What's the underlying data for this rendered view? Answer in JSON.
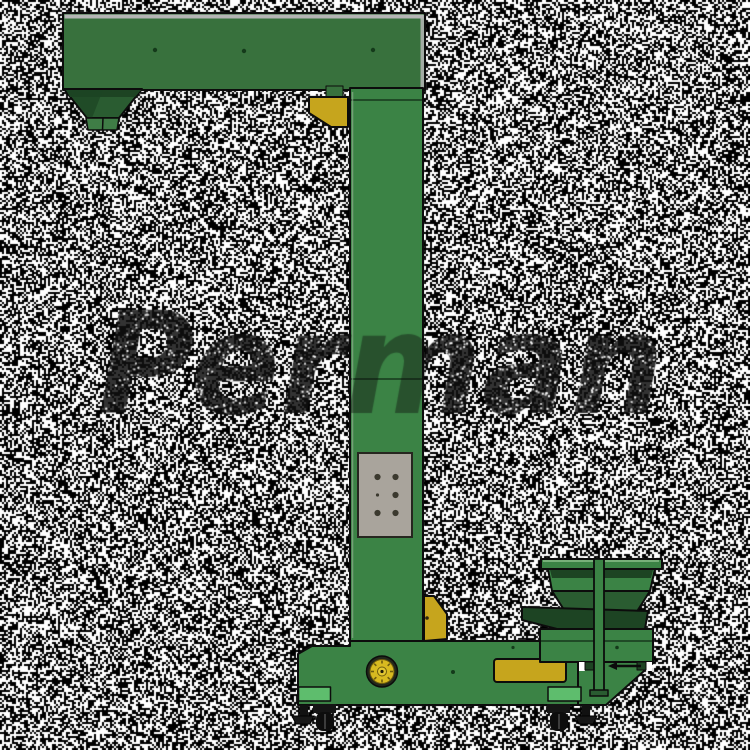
{
  "scene": {
    "background_color": "#ffffff",
    "width": 750,
    "height": 750
  },
  "watermark": {
    "text": "Perman",
    "color": "#0f0f0f",
    "opacity": 0.85,
    "font_px": 140,
    "x": 98,
    "baseline_y": 413,
    "target_width": 566,
    "speck_color": "#ffffff",
    "speck_density": 0.085,
    "speck_size": 2,
    "machine_strip_x0": 349,
    "machine_strip_x1": 426,
    "machine_fade": 0.5,
    "seed": 424242
  },
  "noise": {
    "color": "#000000",
    "density": 0.52,
    "dot_size": 2,
    "seed": 1234567
  },
  "palette": {
    "outline": "#0c0c0c",
    "green_main": "#3b8345",
    "green_arm": "#38713d",
    "green_dark": "#2a5c31",
    "green_darker": "#1d4423",
    "green_spout": "#3f7d46",
    "green_strip": "#5ebd6d",
    "yellow": "#c6a51d",
    "yellow_motor": "#d8ba20",
    "gray_panel": "#a9a49c",
    "gray_top": "#b5b5b5"
  }
}
